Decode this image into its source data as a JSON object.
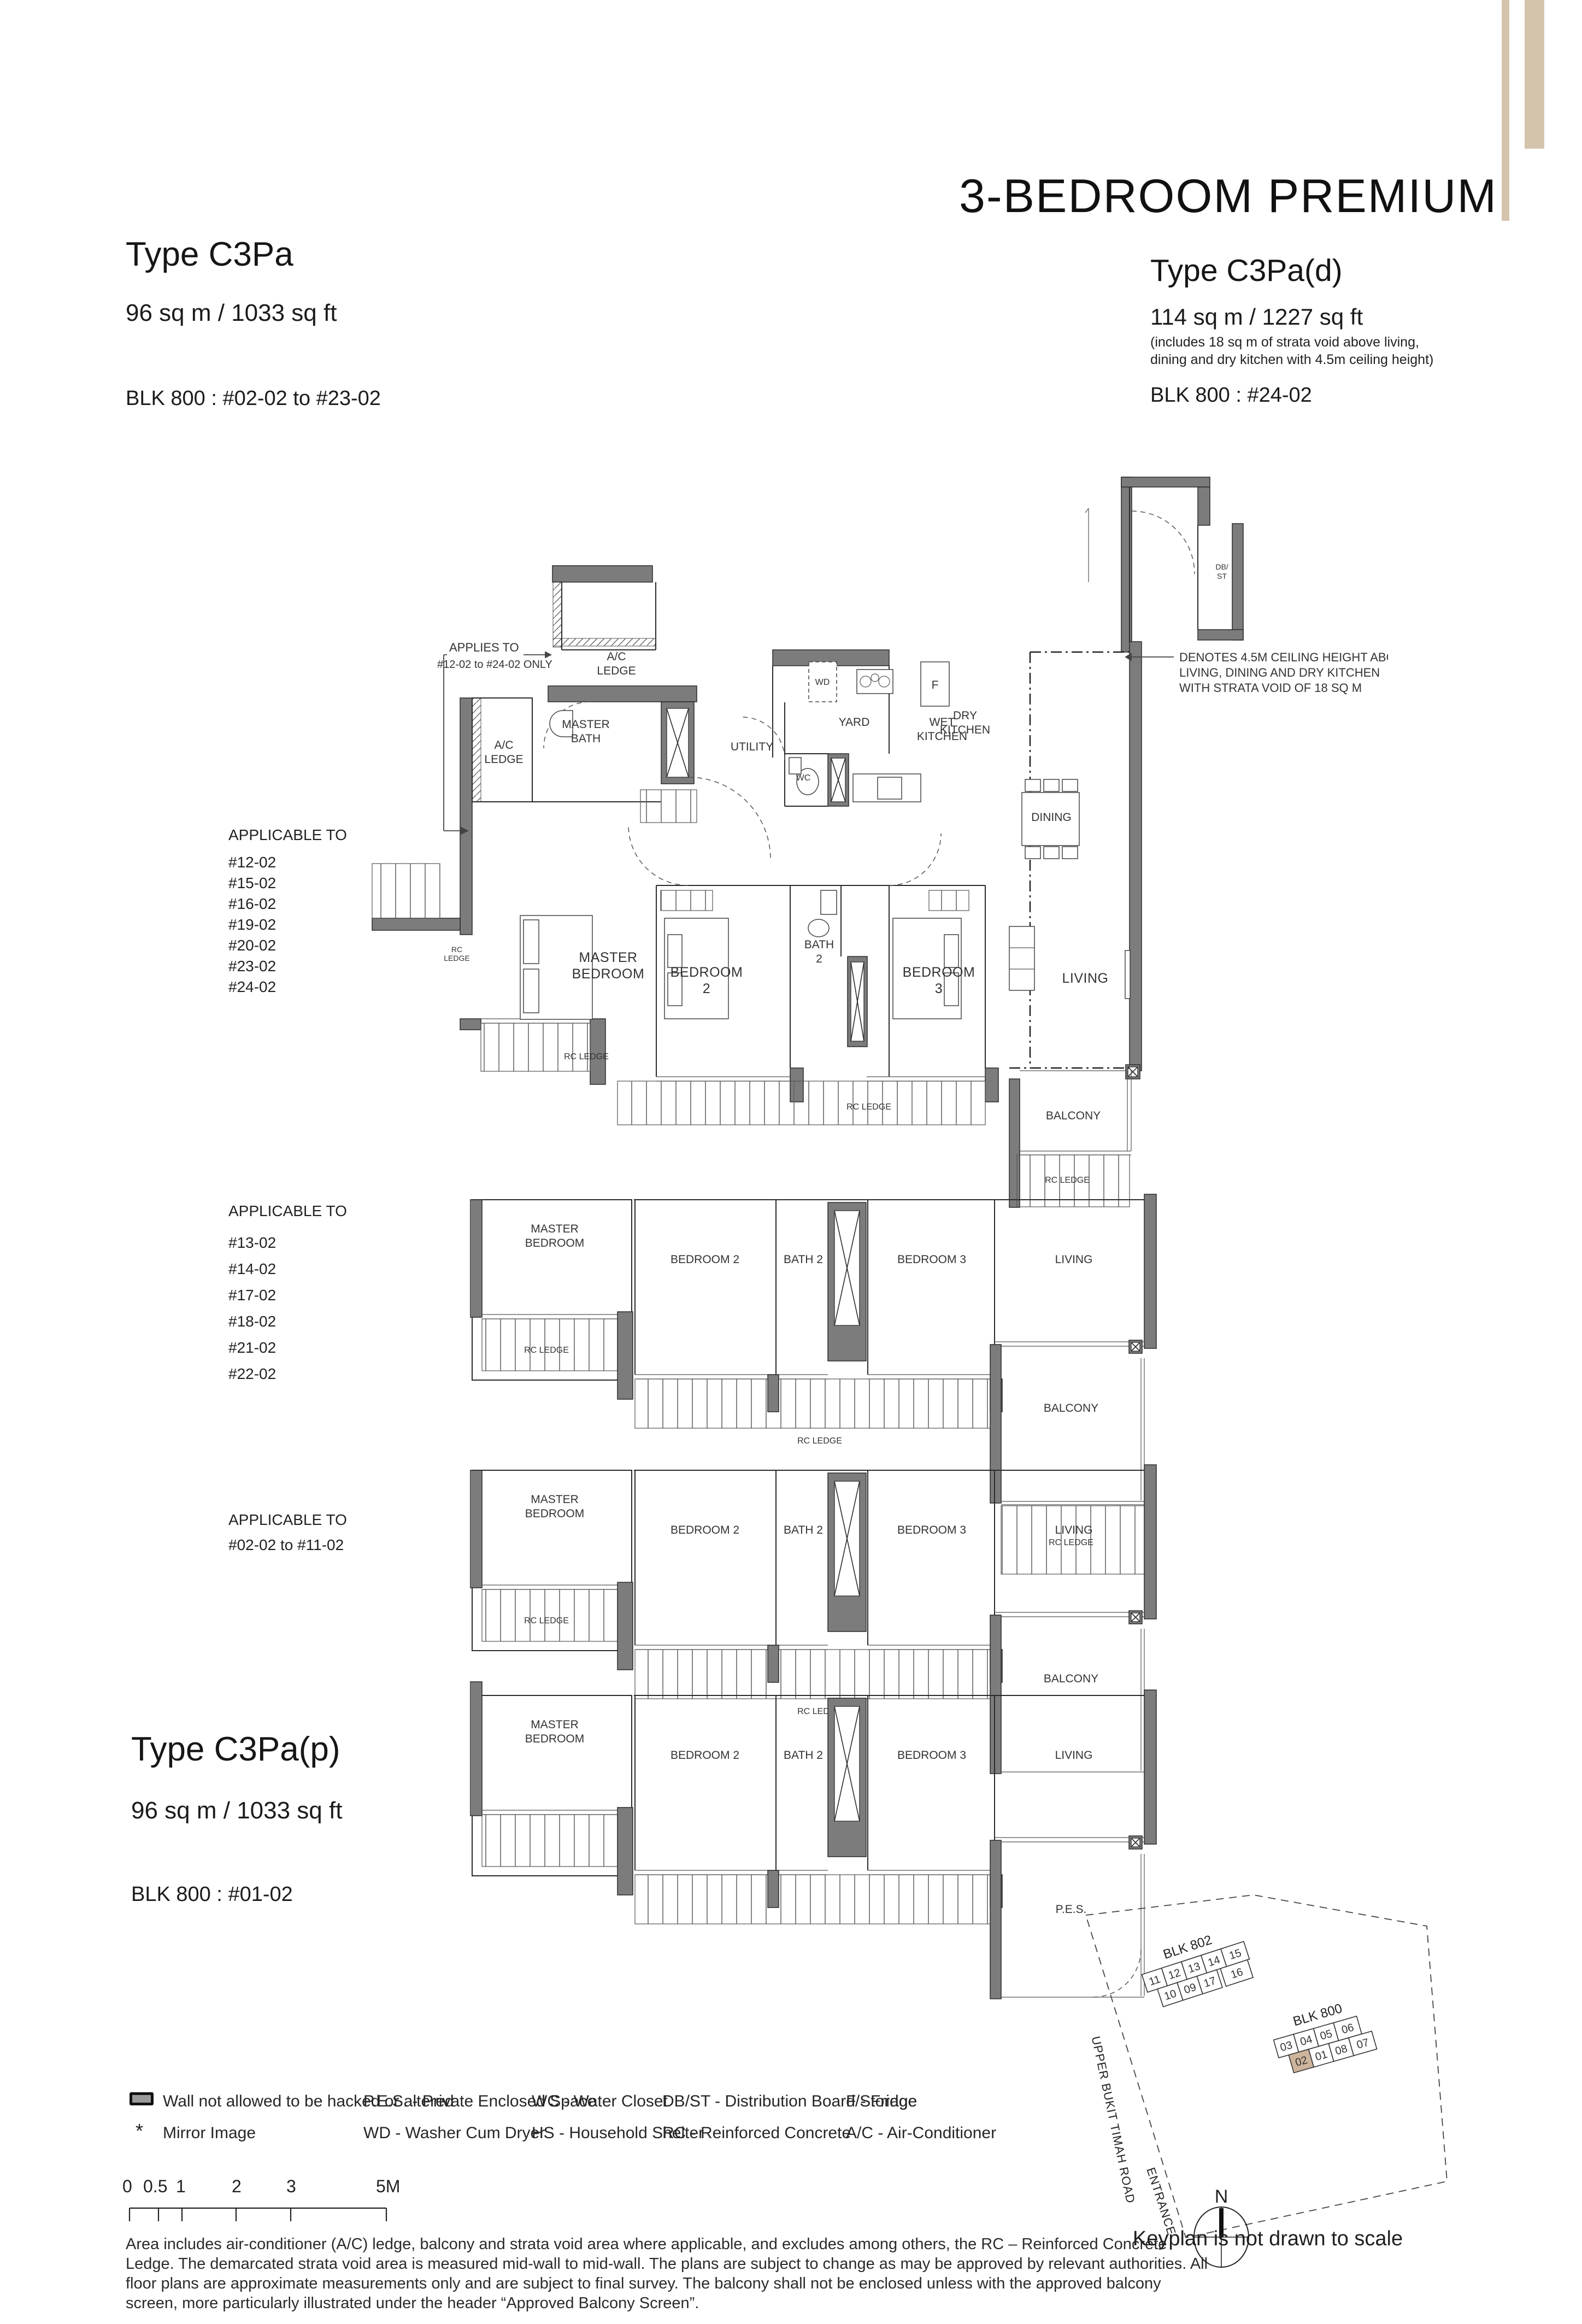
{
  "header": {
    "category": "3-BEDROOM PREMIUM",
    "left": {
      "name": "Type C3Pa",
      "area": "96 sq m / 1033 sq ft",
      "block": "BLK 800 : #02-02 to #23-02"
    },
    "right": {
      "name": "Type C3Pa(d)",
      "area": "114 sq m / 1227 sq ft",
      "note1": "(includes 18 sq m of strata void above living,",
      "note2": "dining and dry kitchen with 4.5m ceiling height)",
      "block": "BLK 800 : #24-02"
    }
  },
  "type_p": {
    "name": "Type C3Pa(p)",
    "area": "96 sq m / 1033 sq ft",
    "block": "BLK 800 : #01-02"
  },
  "notes": {
    "applies1": "APPLIES TO",
    "applies2": "#12-02 to #24-02 ONLY",
    "ceiling1": "DENOTES 4.5M CEILING HEIGHT ABOVE",
    "ceiling2": "LIVING, DINING AND DRY KITCHEN",
    "ceiling3": "WITH STRATA VOID OF 18 SQ M"
  },
  "applicable1": {
    "title": "APPLICABLE TO",
    "units": [
      "#12-02",
      "#15-02",
      "#16-02",
      "#19-02",
      "#20-02",
      "#23-02",
      "#24-02"
    ]
  },
  "applicable2": {
    "title": "APPLICABLE TO",
    "units": [
      "#13-02",
      "#14-02",
      "#17-02",
      "#18-02",
      "#21-02",
      "#22-02"
    ]
  },
  "applicable3": {
    "title": "APPLICABLE TO",
    "range": "#02-02 to #11-02"
  },
  "rooms": {
    "master_bedroom1": "MASTER",
    "master_bedroom2": "BEDROOM",
    "master_bath1": "MASTER",
    "master_bath2": "BATH",
    "bedroom2a": "BEDROOM",
    "bedroom2b": "2",
    "bedroom2": "BEDROOM 2",
    "bedroom3a": "BEDROOM",
    "bedroom3b": "3",
    "bedroom3": "BEDROOM 3",
    "bath2a": "BATH",
    "bath2b": "2",
    "bath2": "BATH 2",
    "living": "LIVING",
    "dining": "DINING",
    "balcony": "BALCONY",
    "pes": "P.E.S.",
    "utility": "UTILITY",
    "yard": "YARD",
    "wet_kitchen1": "WET",
    "wet_kitchen2": "KITCHEN",
    "dry_kitchen1": "DRY",
    "dry_kitchen2": "KITCHEN",
    "wc": "WC",
    "wd": "WD",
    "fridge": "F",
    "dbst1": "DB/",
    "dbst2": "ST",
    "ac1": "A/C",
    "ac2": "LEDGE",
    "rc_ledge": "RC LEDGE",
    "rc1": "RC",
    "rc2": "LEDGE"
  },
  "legend": {
    "wall": "Wall not allowed to be hacked or altered",
    "mirror": "Mirror Image",
    "mirror_icon": "*",
    "pes": "P.E.S. - Private Enclosed Space",
    "wd": "WD - Washer Cum Dryer",
    "wc": "WC - Water Closet",
    "hs": "HS - Household Shelter",
    "dbst": "DB/ST - Distribution Board/Storage",
    "rc": "RC - Reinforced Concrete",
    "f": "F - Fridge",
    "ac": "A/C - Air-Conditioner"
  },
  "scalebar": {
    "t0": "0",
    "t05": "0.5",
    "t1": "1",
    "t2": "2",
    "t3": "3",
    "t5": "5M"
  },
  "disclaimer": [
    "Area includes air-conditioner (A/C) ledge, balcony and strata void area where applicable, and excludes among others, the RC – Reinforced Concrete",
    "Ledge. The demarcated strata void area is measured mid-wall to mid-wall. The plans are subject to change as may be approved by relevant authorities. All",
    "floor plans are approximate measurements only and are subject to final survey. The balcony shall not be enclosed unless with the approved balcony",
    "screen, more particularly illustrated under the header “Approved Balcony Screen”."
  ],
  "keyplan": {
    "blk802": "BLK 802",
    "blk800": "BLK 800",
    "u802t": [
      "11",
      "12",
      "13",
      "14",
      "15"
    ],
    "u802b": [
      "10",
      "09",
      "17",
      "16"
    ],
    "u800t": [
      "03",
      "04",
      "05",
      "06"
    ],
    "u800b": [
      "02",
      "01",
      "08",
      "07"
    ],
    "road": "UPPER BUKIT TIMAH ROAD",
    "entrance": "ENTRANCE",
    "north": "N",
    "note": "Keyplan is not drawn to scale"
  },
  "colors": {
    "tan": "#d5c4ac",
    "wall_gray": "#7c7c7c"
  }
}
